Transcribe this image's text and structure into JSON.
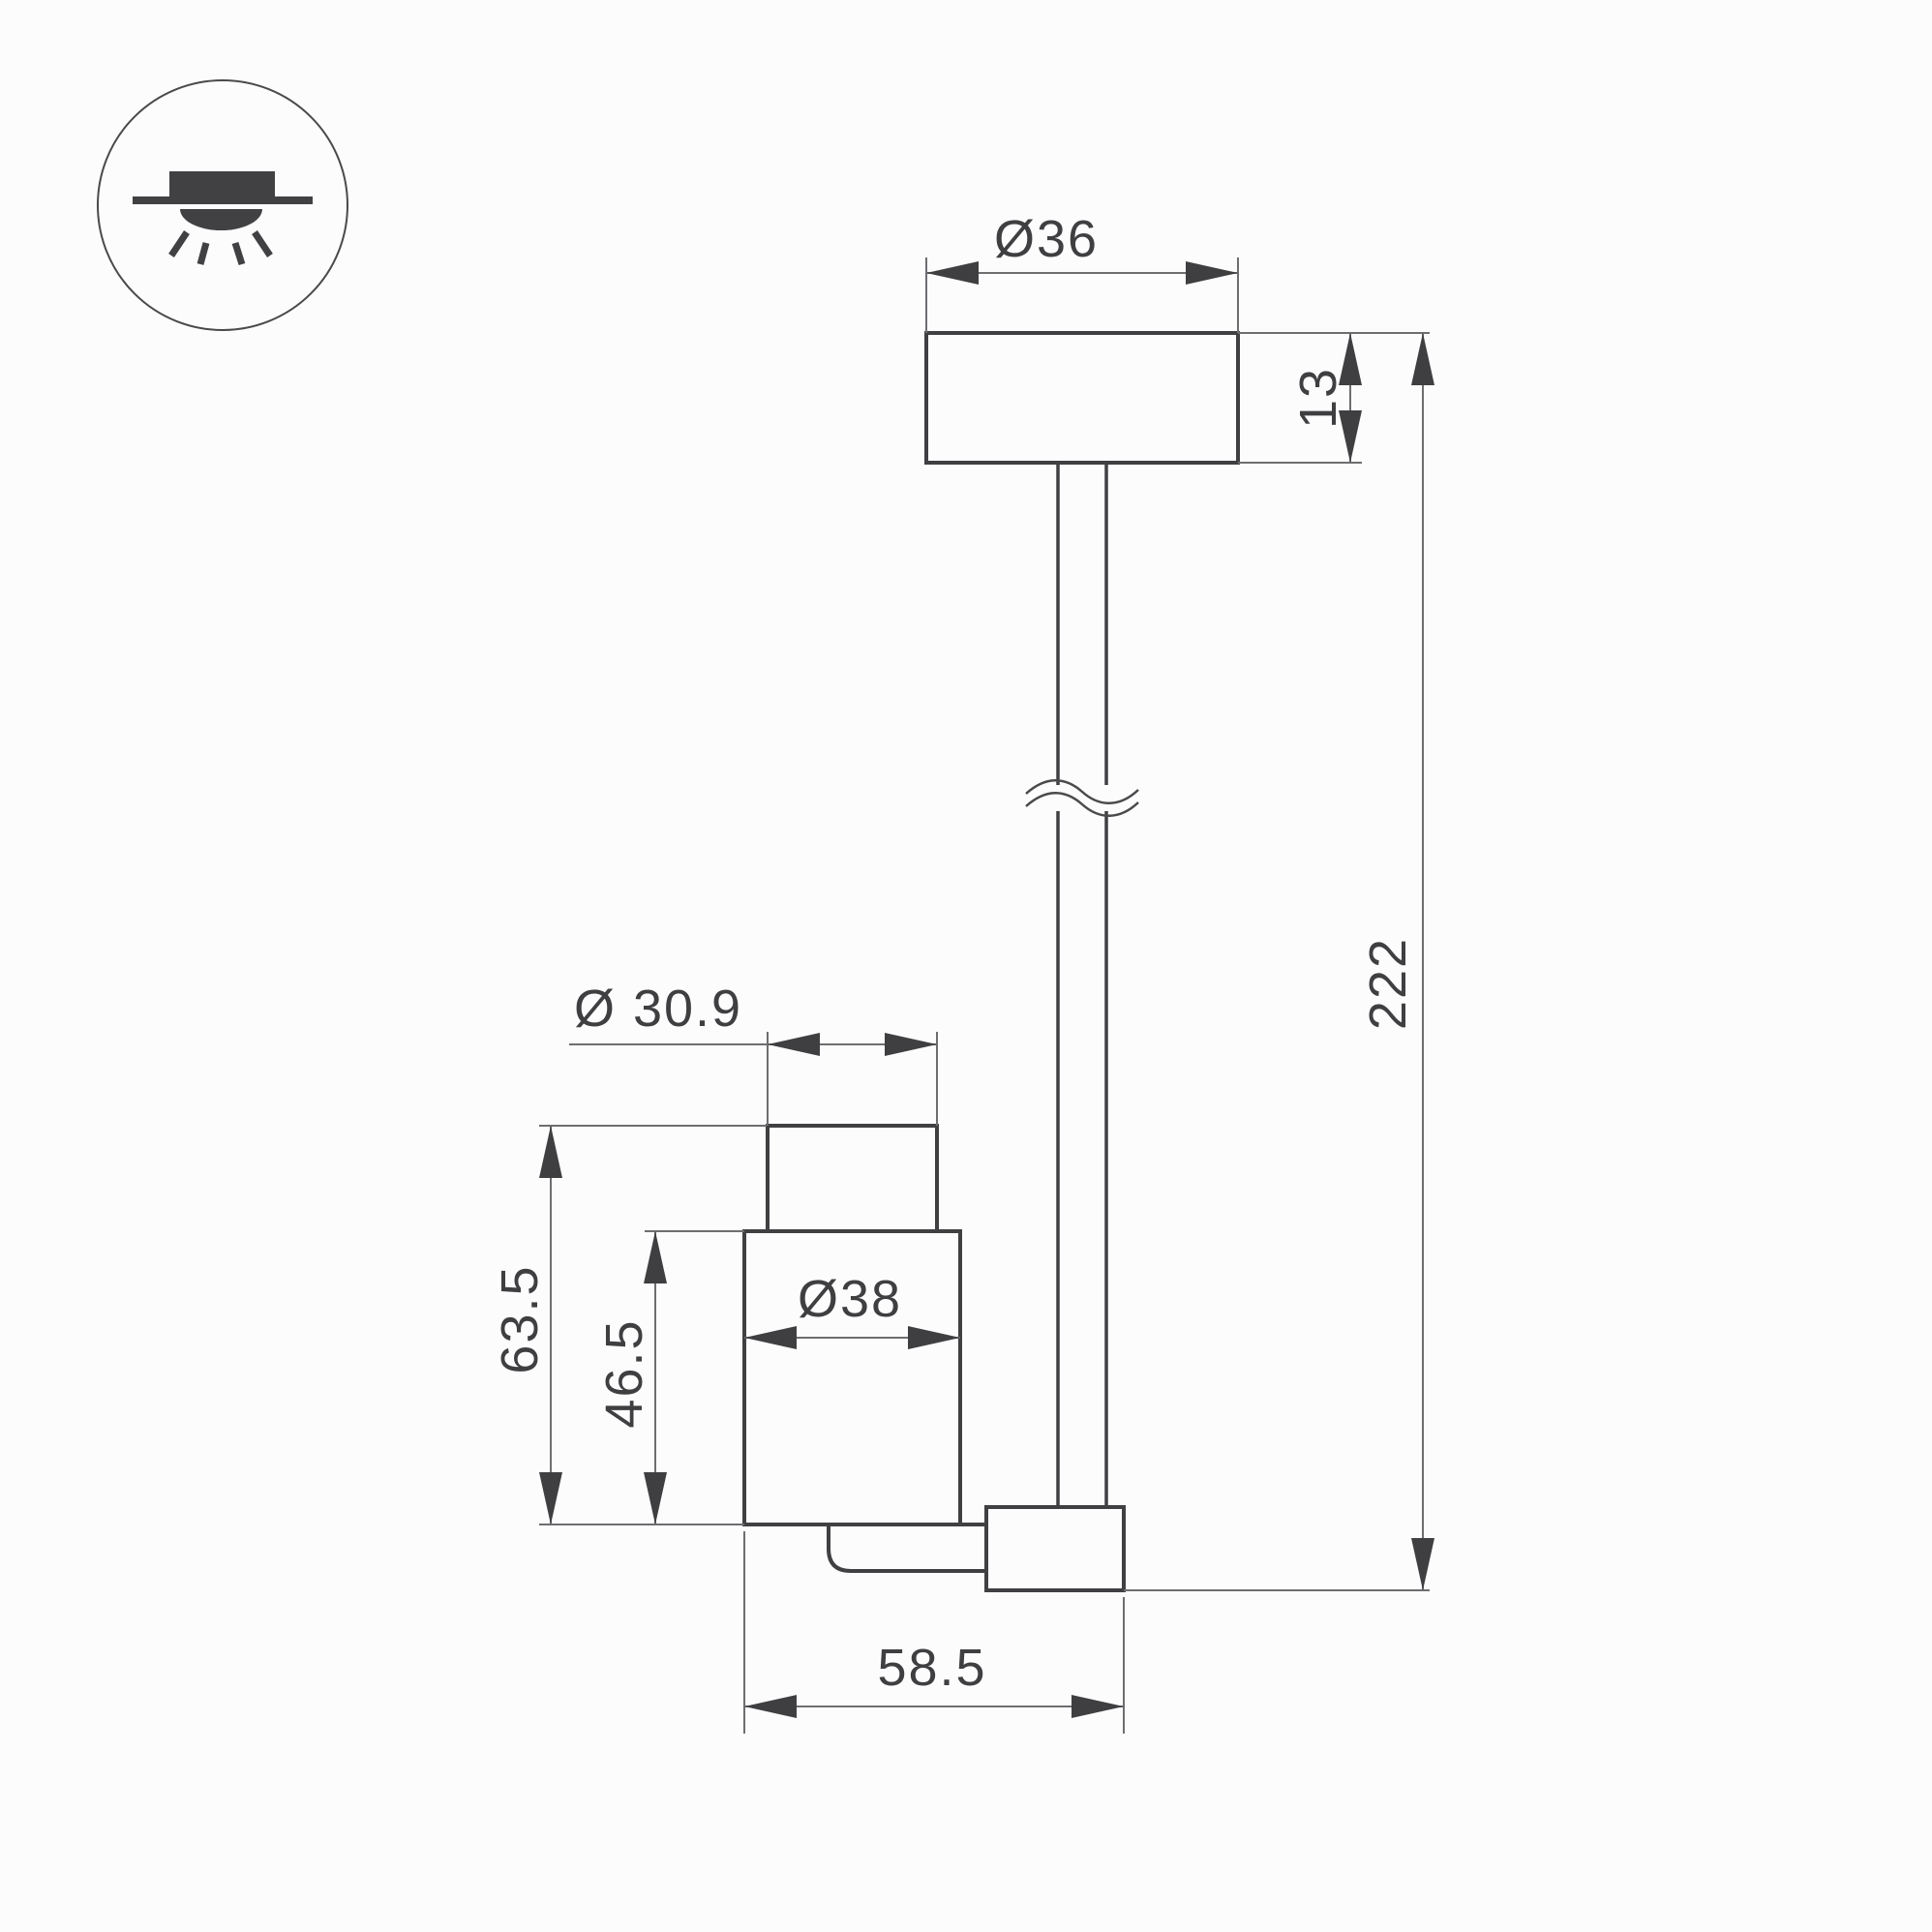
{
  "icon": {
    "name": "surface-mounted-ceiling-light-icon"
  },
  "labels": {
    "canopy_diameter": "Ø36",
    "canopy_height": "13",
    "overall_height": "222",
    "head_top_diameter": "Ø 30.9",
    "head_total_height": "63.5",
    "head_body_height": "46.5",
    "head_body_diameter": "Ø38",
    "head_offset_width": "58.5"
  },
  "colors": {
    "background": "#fcfcfd",
    "outline": "#404043",
    "dimension_line": "#6e6e71",
    "text_and_arrows": "#3f3f42"
  }
}
